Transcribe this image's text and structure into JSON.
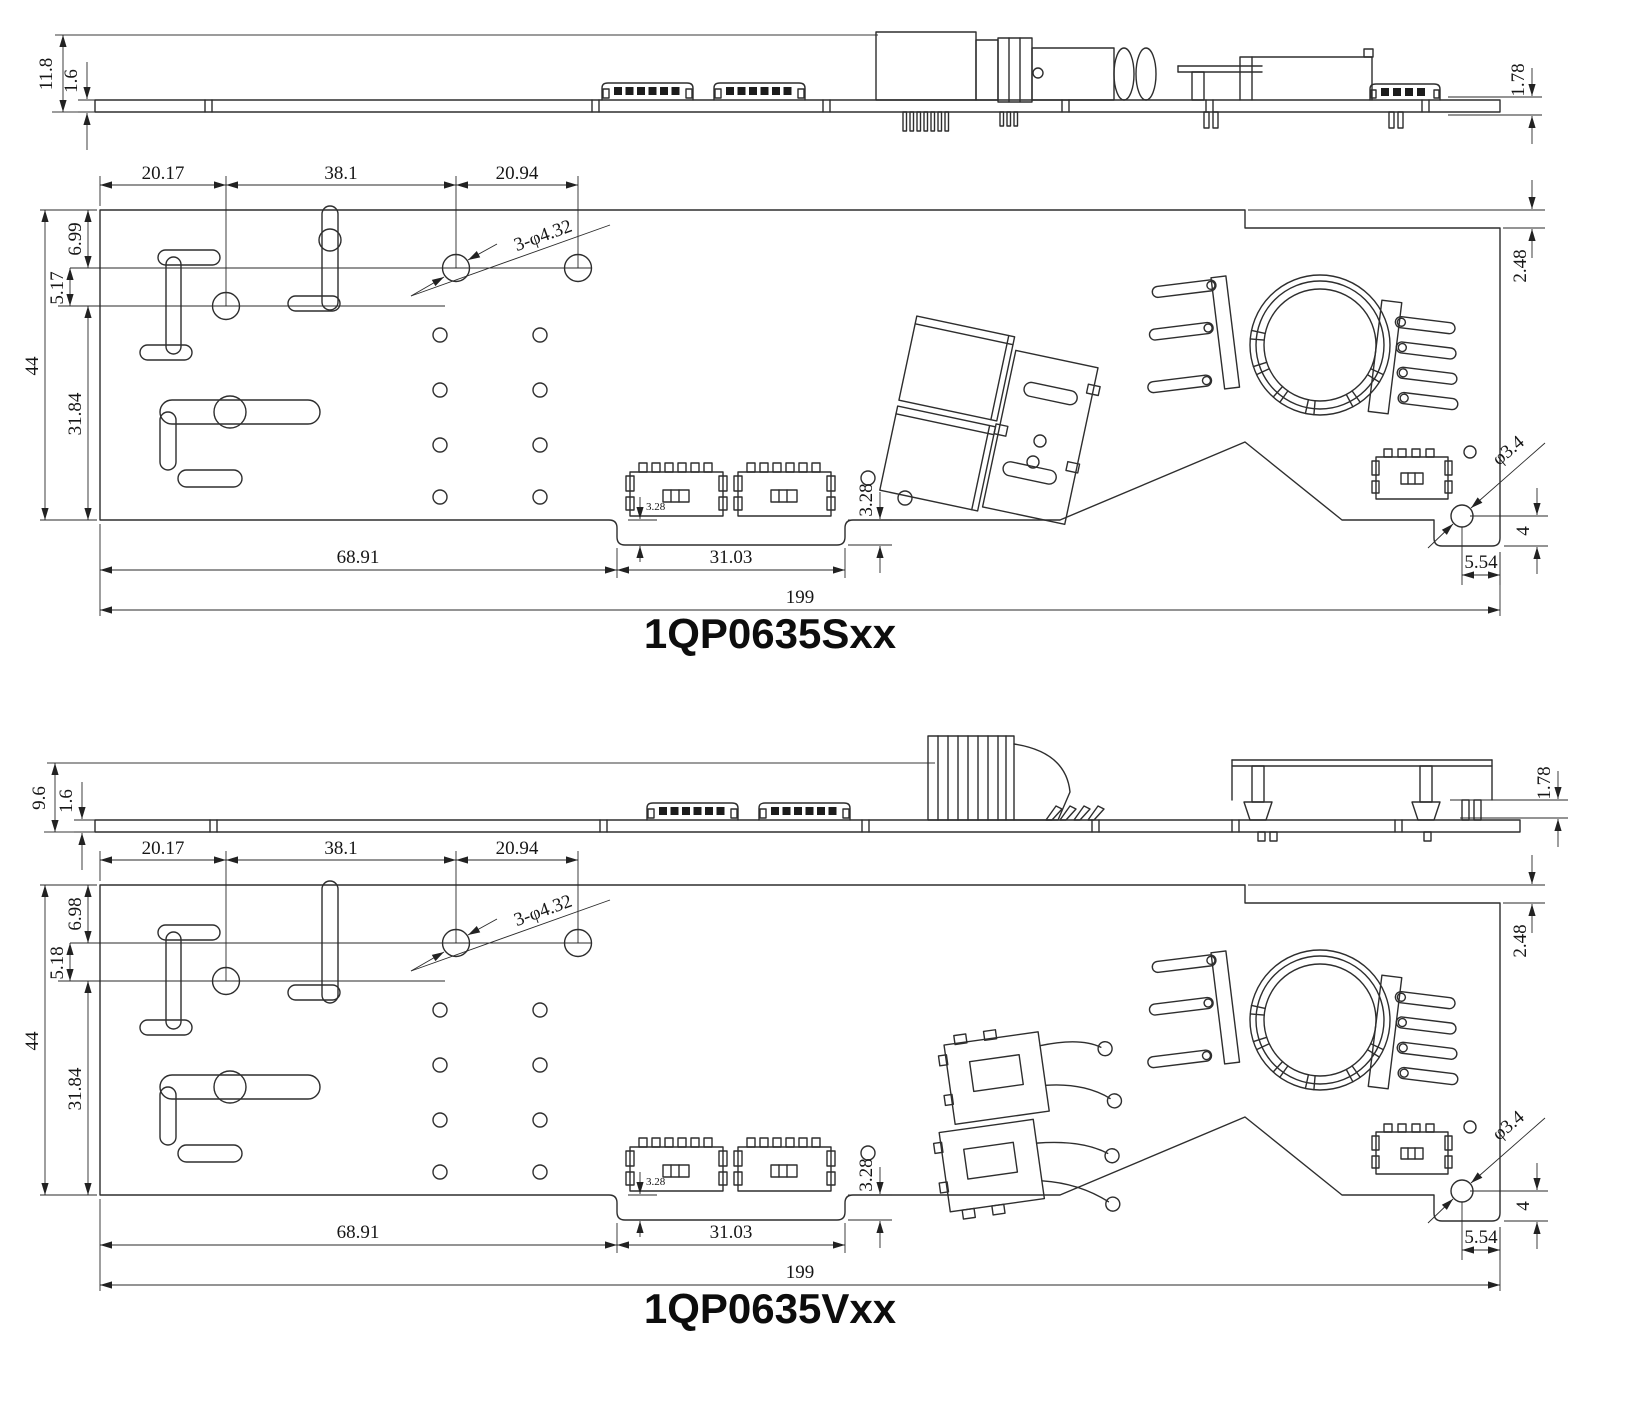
{
  "accent_line_color": "#2e2e2e",
  "views": [
    {
      "title": "1QP0635Sxx",
      "side": {
        "overall_height": "11.8",
        "board_thickness": "1.6",
        "right_clearance": "1.78"
      },
      "top": {
        "w1": "20.17",
        "w2": "38.1",
        "w3": "20.94",
        "left1": "6.99",
        "left2": "5.17",
        "height": "44",
        "left3": "31.84",
        "holes_note": "3-φ4.32",
        "right_step": "2.48",
        "conn_inset": "3.28",
        "tab_step": "3.28",
        "span_left": "68.91",
        "tab_width": "31.03",
        "total": "199",
        "corner_hole": "φ3.4",
        "corner_up": "4",
        "corner_left": "5.54"
      }
    },
    {
      "title": "1QP0635Vxx",
      "side": {
        "overall_height": "9.6",
        "board_thickness": "1.6",
        "right_clearance": "1.78"
      },
      "top": {
        "w1": "20.17",
        "w2": "38.1",
        "w3": "20.94",
        "left1": "6.98",
        "left2": "5.18",
        "height": "44",
        "left3": "31.84",
        "holes_note": "3-φ4.32",
        "right_step": "2.48",
        "conn_inset": "3.28",
        "tab_step": "3.28",
        "span_left": "68.91",
        "tab_width": "31.03",
        "total": "199",
        "corner_hole": "φ3.4",
        "corner_up": "4",
        "corner_left": "5.54"
      }
    }
  ]
}
